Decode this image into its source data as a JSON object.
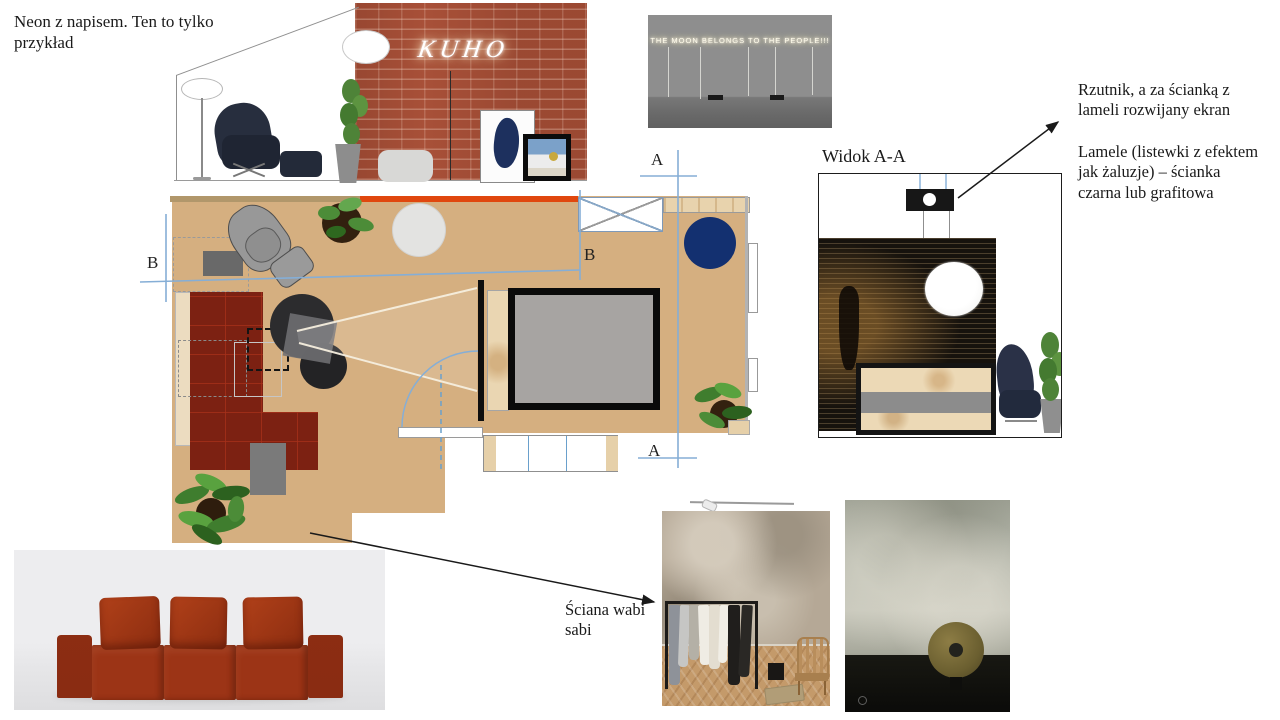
{
  "notes": {
    "top_left": "Neon z napisem. Ten to tylko przykład",
    "projector": "Rzutnik, a za ścianką z lameli rozwijany ekran",
    "lamele": "Lamele (listewki z efektem jak żaluzje)  – ścianka czarna lub grafitowa",
    "view_label": "Widok A-A",
    "wabi_label": "Ściana wabi sabi"
  },
  "neon_signs": {
    "kuho": "KUHO",
    "moon": "THE MOON BELONGS TO THE PEOPLE!!!"
  },
  "plan": {
    "section_marker_a": "A",
    "section_marker_b": "B"
  },
  "colors": {
    "accent_orange": "#e0470e",
    "sofa_red": "#7c2112",
    "navy_rug": "#133070",
    "section_blue": "#85aed6",
    "wood_floor": "#d5af80",
    "brick_wall": "#a85038"
  }
}
